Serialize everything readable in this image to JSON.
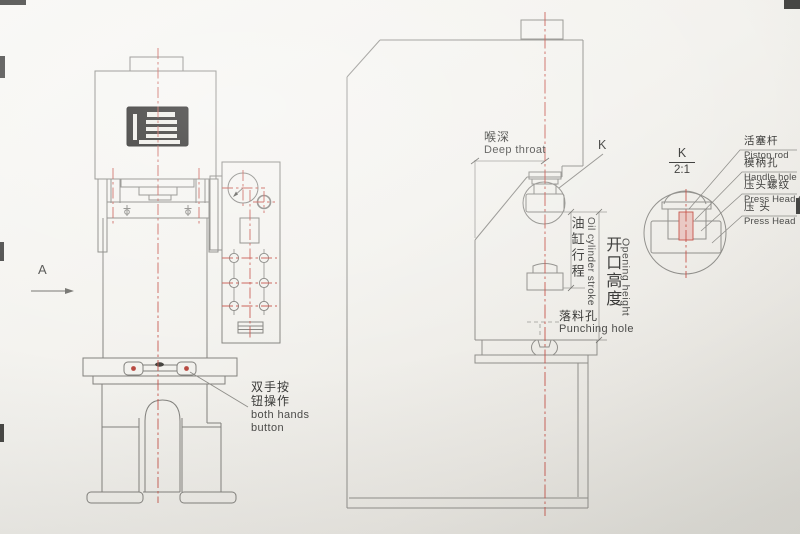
{
  "colors": {
    "paper": "#f3f2ee",
    "line_gray": "#8f8e8a",
    "accent_red": "#c6544b",
    "grille_black": "#1d1c1a",
    "text": "#3a3a38"
  },
  "front_view": {
    "view_label": "A",
    "both_hands": {
      "zh1": "双手按",
      "zh2": "钮操作",
      "en1": "both hands",
      "en2": "button"
    }
  },
  "side_view": {
    "deep_throat": {
      "zh": "喉深",
      "en": "Deep throat"
    },
    "detail_ref": "K",
    "oil_cylinder_stroke": {
      "zh": "油缸行程",
      "en": "Oil cylinder stroke"
    },
    "opening_height": {
      "zh": "开口高度",
      "en": "Opening height"
    },
    "punching_hole": {
      "zh": "落料孔",
      "en": "Punching hole"
    }
  },
  "detail_view": {
    "ref": "K",
    "scale": "2:1",
    "labels": [
      {
        "zh": "活塞杆",
        "en": "Piston rod"
      },
      {
        "zh": "模柄孔",
        "en": "Handle hole"
      },
      {
        "zh": "压头螺纹",
        "en": "Press Head thread"
      },
      {
        "zh": "压 头",
        "en": "Press Head"
      }
    ]
  }
}
